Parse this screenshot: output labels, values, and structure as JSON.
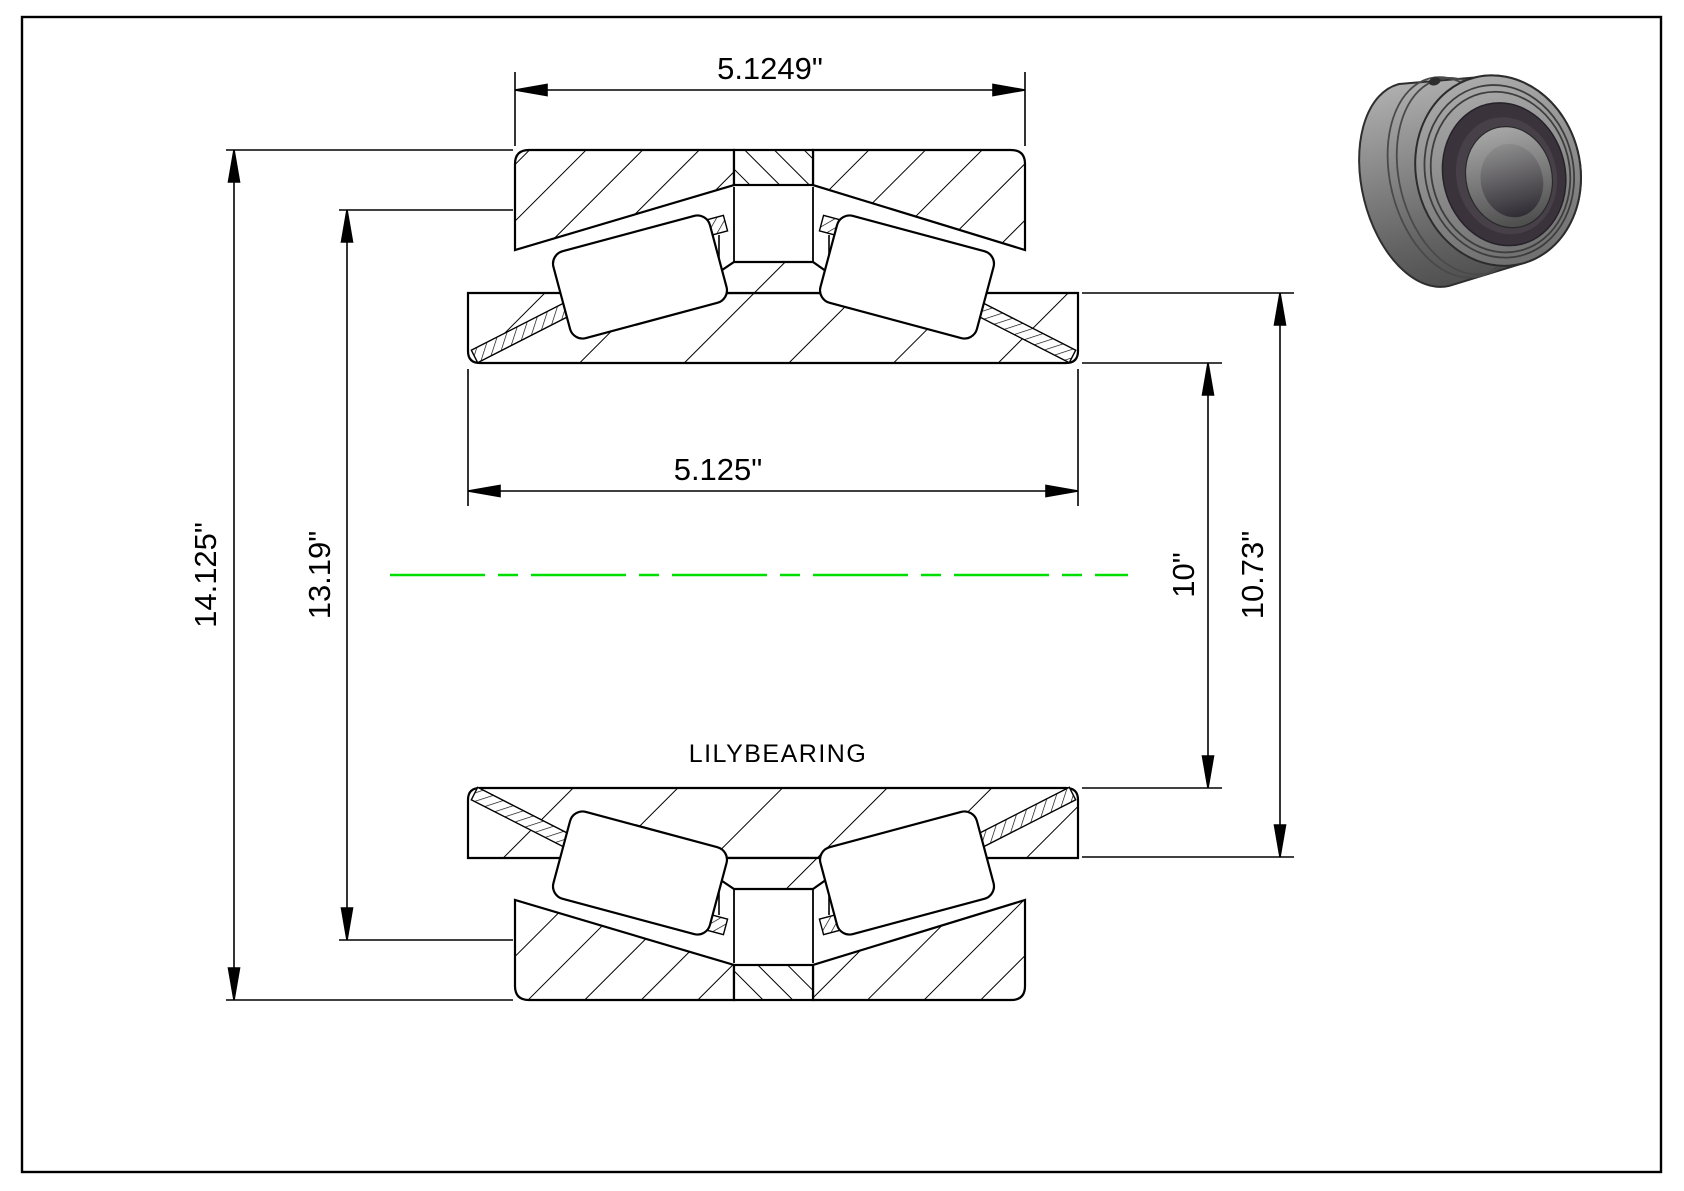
{
  "page": {
    "background": "#ffffff",
    "frame_color": "#000000"
  },
  "drawing": {
    "brand_label": "LILYBEARING",
    "line_color": "#000000",
    "centerline_color": "#00dd00",
    "dimensions": {
      "cup_width": "5.1249\"",
      "cone_width": "5.125\"",
      "outer_diameter": "14.125\"",
      "cup_face_diameter": "13.19\"",
      "bore_diameter": "10\"",
      "rib_diameter": "10.73\""
    }
  },
  "thumbnail": {
    "body_color": "#8d8d8d",
    "dark_ring_color": "#3a333c"
  }
}
